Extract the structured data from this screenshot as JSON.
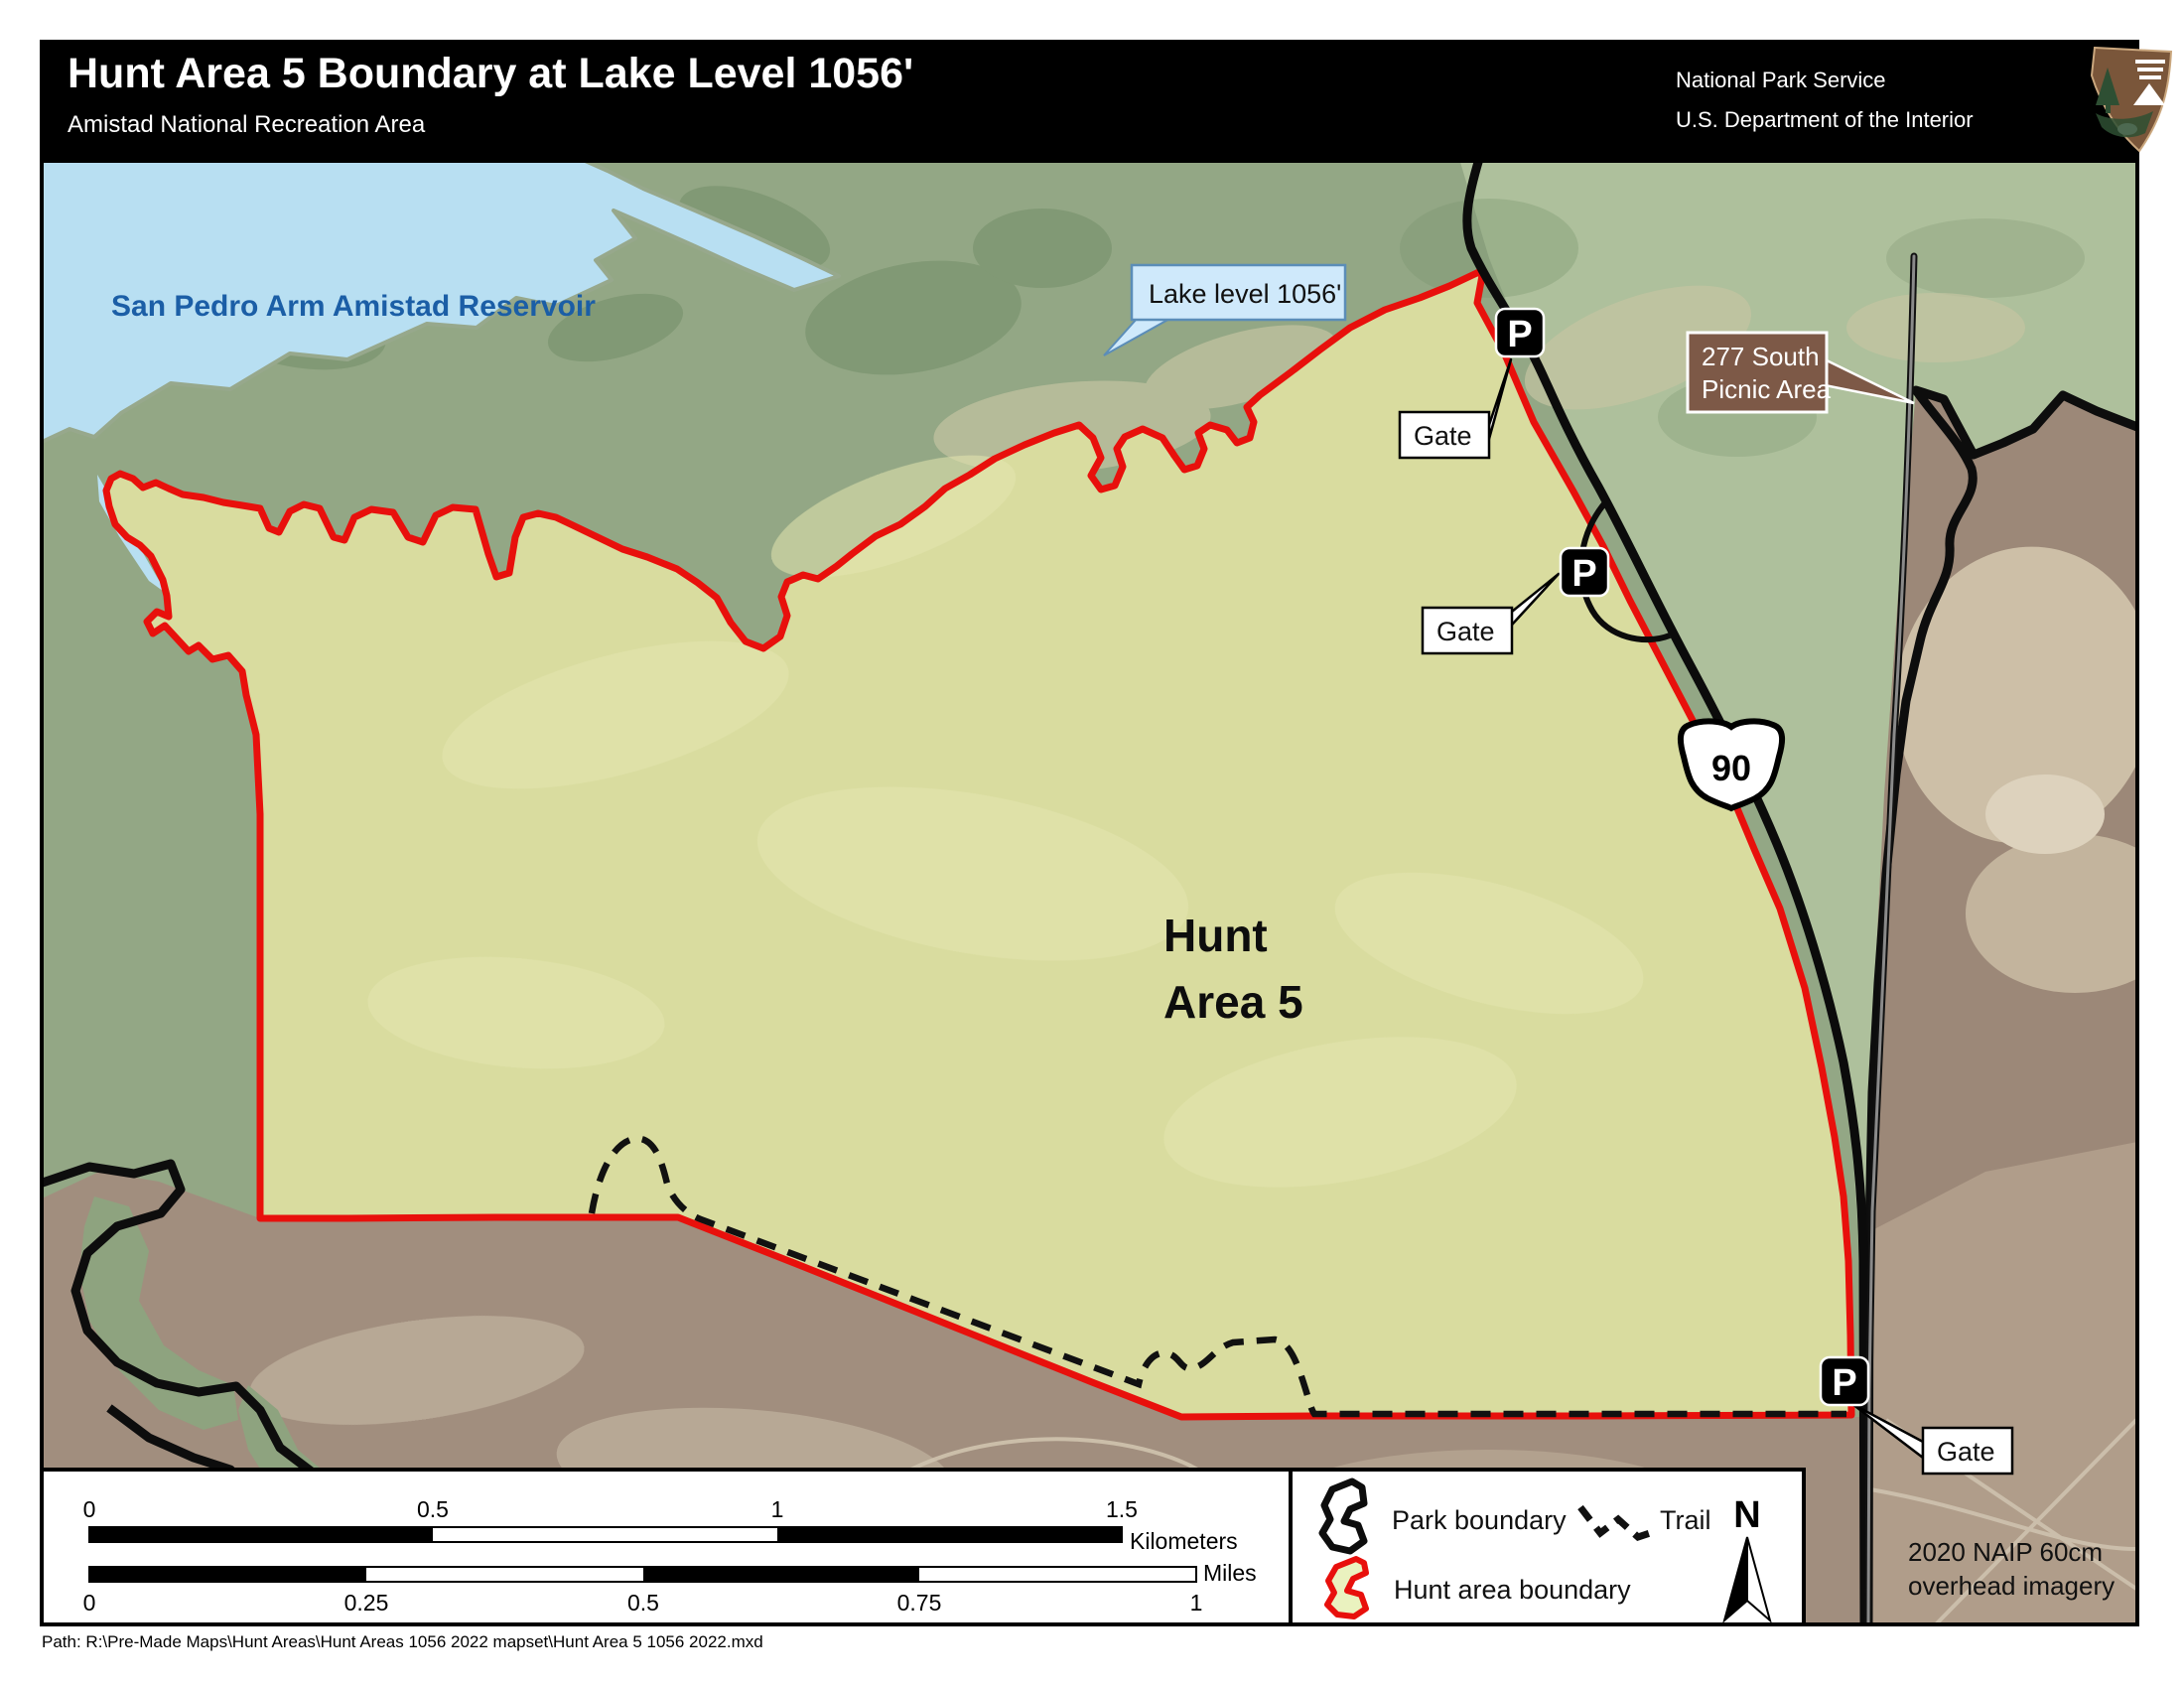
{
  "header": {
    "title": "Hunt Area 5 Boundary at Lake Level 1056'",
    "subtitle": "Amistad National Recreation Area",
    "agency_line1": "National Park Service",
    "agency_line2": "U.S. Department of the Interior",
    "logo_icon": "nps-arrowhead-logo"
  },
  "map": {
    "water_label": "San Pedro Arm Amistad Reservoir",
    "lake_level_callout": "Lake level 1056'",
    "picnic_line1": "277 South",
    "picnic_line2": "Picnic Area",
    "hunt_line1": "Hunt",
    "hunt_line2": "Area 5",
    "gate_label": "Gate",
    "parking_label": "P",
    "route_shield": "90",
    "credit_line1": "2020 NAIP 60cm",
    "credit_line2": "overhead imagery"
  },
  "legend": {
    "park_boundary": "Park boundary",
    "trail": "Trail",
    "hunt_area_boundary": "Hunt area boundary",
    "north": "N"
  },
  "scalebar": {
    "km": {
      "ticks": [
        "0",
        "0.5",
        "1",
        "1.5"
      ],
      "unit": "Kilometers"
    },
    "miles": {
      "ticks": [
        "0",
        "0.25",
        "0.5",
        "0.75",
        "1"
      ],
      "unit": "Miles"
    }
  },
  "footer": {
    "path": "Path: R:\\Pre-Made Maps\\Hunt Areas\\Hunt Areas 1056 2022 mapset\\Hunt Area 5 1056 2022.mxd"
  },
  "colors": {
    "hunt_boundary_red": "#e8100c",
    "hunt_fill": "#d9dc9f",
    "water_blue": "#b8dff2",
    "water_label_blue": "#1b5ea6",
    "callout_blue_fill": "#cfe9fb",
    "picnic_brown": "#7d5947",
    "land_green": "#93a785",
    "desert_brown": "#9c8878"
  }
}
